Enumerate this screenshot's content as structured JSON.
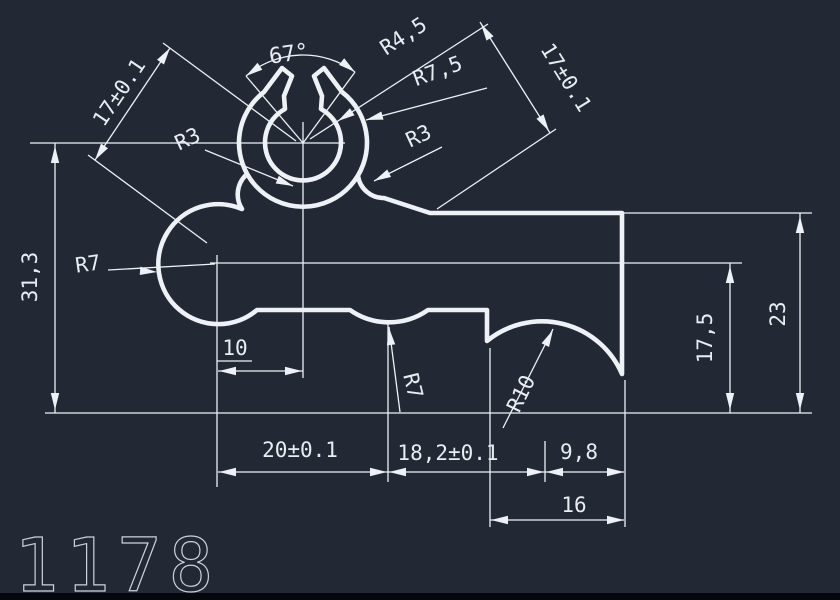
{
  "drawing": {
    "number": "1178",
    "background": "#222834",
    "line_color": "#eef1f5",
    "text_color": "#e9ecf1",
    "number_color": "#ccd2da",
    "bottom_bar_color": "#05070a"
  },
  "dimension_summary": {
    "angular": [
      "67°"
    ],
    "radii": [
      "R4,5",
      "R7,5",
      "R3",
      "R3",
      "R7",
      "R7",
      "R10"
    ],
    "linear": [
      "17±0.1",
      "17±0.1",
      "31,3",
      "10",
      "20±0.1",
      "18,2±0.1",
      "9,8",
      "16",
      "17,5",
      "23"
    ]
  },
  "labels": [
    {
      "id": "dim-17-left",
      "text": "17±0.1",
      "x": 120,
      "y": 93,
      "rot": -56,
      "fs": 21
    },
    {
      "id": "angle-67",
      "text": "67°",
      "x": 289,
      "y": 55,
      "rot": -8,
      "fs": 22
    },
    {
      "id": "rad-r4-5",
      "text": "R4,5",
      "x": 404,
      "y": 37,
      "rot": -33,
      "fs": 21
    },
    {
      "id": "rad-r7-5",
      "text": "R7,5",
      "x": 438,
      "y": 72,
      "rot": -20,
      "fs": 21
    },
    {
      "id": "dim-17-right",
      "text": "17±0.1",
      "x": 565,
      "y": 78,
      "rot": 58,
      "fs": 21
    },
    {
      "id": "rad-r3-left",
      "text": "R3",
      "x": 188,
      "y": 140,
      "rot": -25,
      "fs": 21
    },
    {
      "id": "rad-r3-right",
      "text": "R3",
      "x": 419,
      "y": 137,
      "rot": -25,
      "fs": 21
    },
    {
      "id": "rad-r7-left",
      "text": "R7",
      "x": 88,
      "y": 265,
      "rot": -8,
      "fs": 21
    },
    {
      "id": "dim-31-3",
      "text": "31,3",
      "x": 31,
      "y": 277,
      "rot": -90,
      "fs": 21
    },
    {
      "id": "dim-10",
      "text": "10",
      "x": 235,
      "y": 349,
      "rot": 0,
      "fs": 21
    },
    {
      "id": "rad-r7-dip",
      "text": "R7",
      "x": 412,
      "y": 386,
      "rot": 76,
      "fs": 21
    },
    {
      "id": "rad-r10",
      "text": "R10",
      "x": 522,
      "y": 394,
      "rot": -64,
      "fs": 21
    },
    {
      "id": "dim-20",
      "text": "20±0.1",
      "x": 300,
      "y": 451,
      "rot": 0,
      "fs": 21
    },
    {
      "id": "dim-18-2",
      "text": "18,2±0.1",
      "x": 448,
      "y": 454,
      "rot": 0,
      "fs": 21
    },
    {
      "id": "dim-9-8",
      "text": "9,8",
      "x": 579,
      "y": 453,
      "rot": 0,
      "fs": 21
    },
    {
      "id": "dim-16",
      "text": "16",
      "x": 574,
      "y": 506,
      "rot": 0,
      "fs": 21
    },
    {
      "id": "dim-17-5",
      "text": "17,5",
      "x": 706,
      "y": 338,
      "rot": -90,
      "fs": 21
    },
    {
      "id": "dim-23",
      "text": "23",
      "x": 779,
      "y": 314,
      "rot": -90,
      "fs": 21
    }
  ]
}
